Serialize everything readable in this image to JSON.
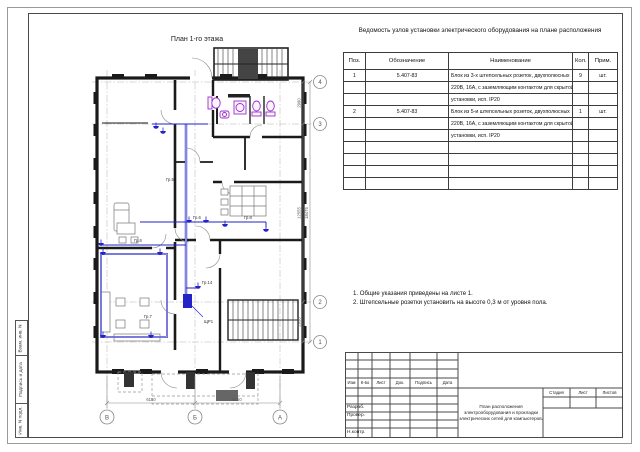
{
  "colors": {
    "wall": "#1a1a1a",
    "wiring": "#2323c8",
    "fixture": "#9b30c8",
    "dim_lines": "#888888"
  },
  "plan": {
    "title": "План 1-го этажа",
    "wire_labels": [
      "Гр.5",
      "Гр.6",
      "Гр.6",
      "Гр.8",
      "Гр.14",
      "Гр.7",
      "ЩР1"
    ],
    "axis_numbers": [
      "4",
      "3",
      "2",
      "1"
    ],
    "axis_letters": [
      "В",
      "Б",
      "А"
    ],
    "dim_right_segments": [
      "2990",
      "12555",
      "2930"
    ],
    "dim_right_total": "18475",
    "dim_bottom": [
      "6150",
      "6150"
    ]
  },
  "spec_table": {
    "title": "Ведомость узлов установки электрического оборудования на плане расположения",
    "headers": [
      "Поз.",
      "Обозначение",
      "Наименование",
      "Кол.",
      "Прим."
    ],
    "rows": [
      {
        "pos": "1",
        "designation": "5.407-83",
        "name_lines": [
          "Блок из 3-х штепсельных розеток, двухполюсных",
          "220В, 16А, с заземляющим контактом для скрытой",
          "установки, исп. IP20"
        ],
        "qty": "9",
        "unit": "шт."
      },
      {
        "pos": "2",
        "designation": "5.407-83",
        "name_lines": [
          "Блок из 5-и штепсельных розеток, двухполюсных",
          "220В, 16А, с заземляющим контактом для скрытой",
          "установки, исп. IP20"
        ],
        "qty": "1",
        "unit": "шт."
      }
    ]
  },
  "notes": {
    "lines": [
      "1. Общие указания приведены на листе 1.",
      "2. Штепсельные розетки установить на высоте 0,3 м от уровня пола."
    ]
  },
  "title_block": {
    "change_headers": [
      "Изм",
      "К-во",
      "Лист",
      "Док.",
      "Подпись",
      "Дата"
    ],
    "signature_rows": [
      "Разраб.",
      "Провер.",
      "Н.контр."
    ],
    "doc_title": "План расположения электрооборудования и прокладки электрических сетей для компьютеров.",
    "stage_headers": [
      "Стадия",
      "Лист",
      "Листов"
    ]
  },
  "side_column": {
    "labels": [
      "Взам. инв. N",
      "Подпись и дата",
      "Инв. N подл."
    ]
  }
}
